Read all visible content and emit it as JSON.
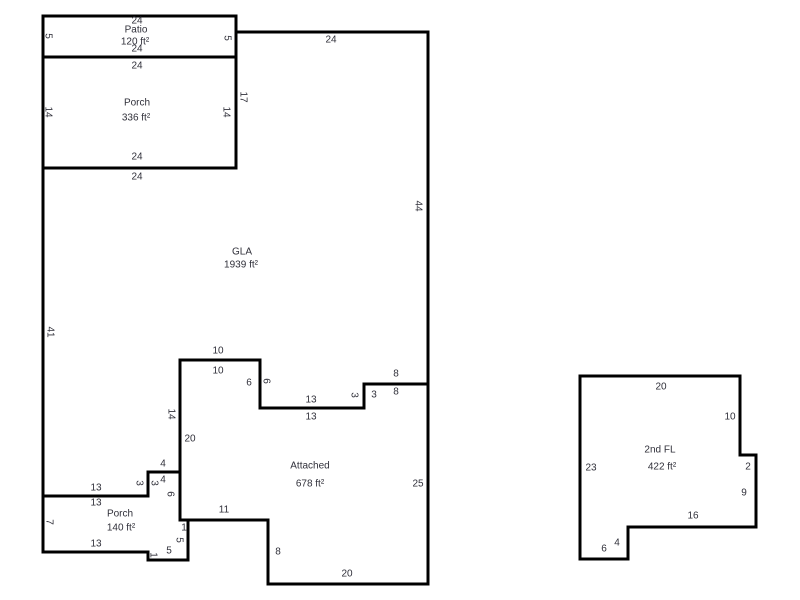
{
  "canvas": {
    "background_color": "#ffffff",
    "wall_color": "#000000",
    "text_color": "#30303a"
  },
  "floorplan": {
    "regions": [
      {
        "id": "patio",
        "label": "Patio",
        "area": "120 ft²",
        "outline": [
          [
            43,
            16
          ],
          [
            236,
            16
          ],
          [
            236,
            57
          ],
          [
            43,
            57
          ]
        ],
        "label_pos": [
          136,
          30
        ],
        "area_pos": [
          135,
          42
        ]
      },
      {
        "id": "porch-336",
        "label": "Porch",
        "area": "336 ft²",
        "outline": [
          [
            43,
            57
          ],
          [
            236,
            57
          ],
          [
            236,
            168
          ],
          [
            43,
            168
          ]
        ],
        "label_pos": [
          137,
          103
        ],
        "area_pos": [
          136,
          118
        ]
      },
      {
        "id": "gla",
        "label": "GLA",
        "area": "1939 ft²",
        "outline": [
          [
            236,
            32
          ],
          [
            428,
            32
          ],
          [
            428,
            384
          ],
          [
            364,
            384
          ],
          [
            364,
            408
          ],
          [
            260,
            408
          ],
          [
            260,
            360
          ],
          [
            180,
            360
          ],
          [
            180,
            472
          ],
          [
            148,
            472
          ],
          [
            148,
            496
          ],
          [
            43,
            496
          ],
          [
            43,
            168
          ],
          [
            236,
            168
          ]
        ],
        "label_pos": [
          242,
          252
        ],
        "area_pos": [
          241,
          265
        ]
      },
      {
        "id": "attached",
        "label": "Attached",
        "area": "678 ft²",
        "outline": [
          [
            180,
            360
          ],
          [
            260,
            360
          ],
          [
            260,
            408
          ],
          [
            364,
            408
          ],
          [
            364,
            384
          ],
          [
            428,
            384
          ],
          [
            428,
            584
          ],
          [
            268,
            584
          ],
          [
            268,
            520
          ],
          [
            180,
            520
          ]
        ],
        "label_pos": [
          310,
          466
        ],
        "area_pos": [
          310,
          484
        ]
      },
      {
        "id": "porch-140",
        "label": "Porch",
        "area": "140 ft²",
        "outline": [
          [
            43,
            496
          ],
          [
            148,
            496
          ],
          [
            148,
            472
          ],
          [
            180,
            472
          ],
          [
            180,
            520
          ],
          [
            188,
            520
          ],
          [
            188,
            560
          ],
          [
            148,
            560
          ],
          [
            148,
            552
          ],
          [
            43,
            552
          ]
        ],
        "label_pos": [
          120,
          514
        ],
        "area_pos": [
          121,
          528
        ]
      },
      {
        "id": "second-floor",
        "label": "2nd FL",
        "area": "422 ft²",
        "outline": [
          [
            580,
            376
          ],
          [
            740,
            376
          ],
          [
            740,
            455
          ],
          [
            756,
            455
          ],
          [
            756,
            527
          ],
          [
            628,
            527
          ],
          [
            628,
            559
          ],
          [
            580,
            559
          ]
        ],
        "label_pos": [
          660,
          450
        ],
        "area_pos": [
          662,
          467
        ]
      }
    ],
    "dimensions": [
      {
        "text": "24",
        "x": 137,
        "y": 21
      },
      {
        "text": "24",
        "x": 137,
        "y": 49
      },
      {
        "text": "5",
        "x": 48,
        "y": 36,
        "vertical": true
      },
      {
        "text": "5",
        "x": 227,
        "y": 38,
        "vertical": true
      },
      {
        "text": "24",
        "x": 137,
        "y": 66
      },
      {
        "text": "24",
        "x": 137,
        "y": 157
      },
      {
        "text": "14",
        "x": 48,
        "y": 112,
        "vertical": true
      },
      {
        "text": "14",
        "x": 226,
        "y": 112,
        "vertical": true
      },
      {
        "text": "24",
        "x": 137,
        "y": 177
      },
      {
        "text": "17",
        "x": 243,
        "y": 97,
        "vertical": true
      },
      {
        "text": "24",
        "x": 331,
        "y": 40
      },
      {
        "text": "44",
        "x": 418,
        "y": 206,
        "vertical": true
      },
      {
        "text": "41",
        "x": 50,
        "y": 332,
        "vertical": true
      },
      {
        "text": "10",
        "x": 218,
        "y": 351
      },
      {
        "text": "10",
        "x": 218,
        "y": 371
      },
      {
        "text": "6",
        "x": 249,
        "y": 383
      },
      {
        "text": "6",
        "x": 266,
        "y": 381,
        "vertical": true
      },
      {
        "text": "13",
        "x": 311,
        "y": 400
      },
      {
        "text": "13",
        "x": 311,
        "y": 417
      },
      {
        "text": "3",
        "x": 354,
        "y": 395,
        "vertical": true
      },
      {
        "text": "3",
        "x": 374,
        "y": 395
      },
      {
        "text": "8",
        "x": 396,
        "y": 374
      },
      {
        "text": "8",
        "x": 396,
        "y": 392
      },
      {
        "text": "14",
        "x": 171,
        "y": 414,
        "vertical": true
      },
      {
        "text": "20",
        "x": 190,
        "y": 439
      },
      {
        "text": "25",
        "x": 418,
        "y": 484
      },
      {
        "text": "20",
        "x": 347,
        "y": 574
      },
      {
        "text": "8",
        "x": 278,
        "y": 552
      },
      {
        "text": "11",
        "x": 224,
        "y": 510
      },
      {
        "text": "4",
        "x": 163,
        "y": 464
      },
      {
        "text": "4",
        "x": 163,
        "y": 480
      },
      {
        "text": "3",
        "x": 139,
        "y": 483,
        "vertical": true
      },
      {
        "text": "3",
        "x": 154,
        "y": 483,
        "vertical": true
      },
      {
        "text": "13",
        "x": 96,
        "y": 488
      },
      {
        "text": "13",
        "x": 96,
        "y": 503
      },
      {
        "text": "6",
        "x": 170,
        "y": 494,
        "vertical": true
      },
      {
        "text": "1",
        "x": 184,
        "y": 528
      },
      {
        "text": "5",
        "x": 179,
        "y": 540,
        "vertical": true
      },
      {
        "text": "5",
        "x": 169,
        "y": 551
      },
      {
        "text": "1",
        "x": 153,
        "y": 555,
        "vertical": true
      },
      {
        "text": "13",
        "x": 96,
        "y": 544
      },
      {
        "text": "7",
        "x": 49,
        "y": 522,
        "vertical": true
      },
      {
        "text": "20",
        "x": 661,
        "y": 387
      },
      {
        "text": "10",
        "x": 730,
        "y": 417
      },
      {
        "text": "2",
        "x": 748,
        "y": 467
      },
      {
        "text": "9",
        "x": 744,
        "y": 493
      },
      {
        "text": "16",
        "x": 693,
        "y": 516
      },
      {
        "text": "4",
        "x": 617,
        "y": 543
      },
      {
        "text": "6",
        "x": 604,
        "y": 549
      },
      {
        "text": "23",
        "x": 591,
        "y": 468
      }
    ]
  }
}
